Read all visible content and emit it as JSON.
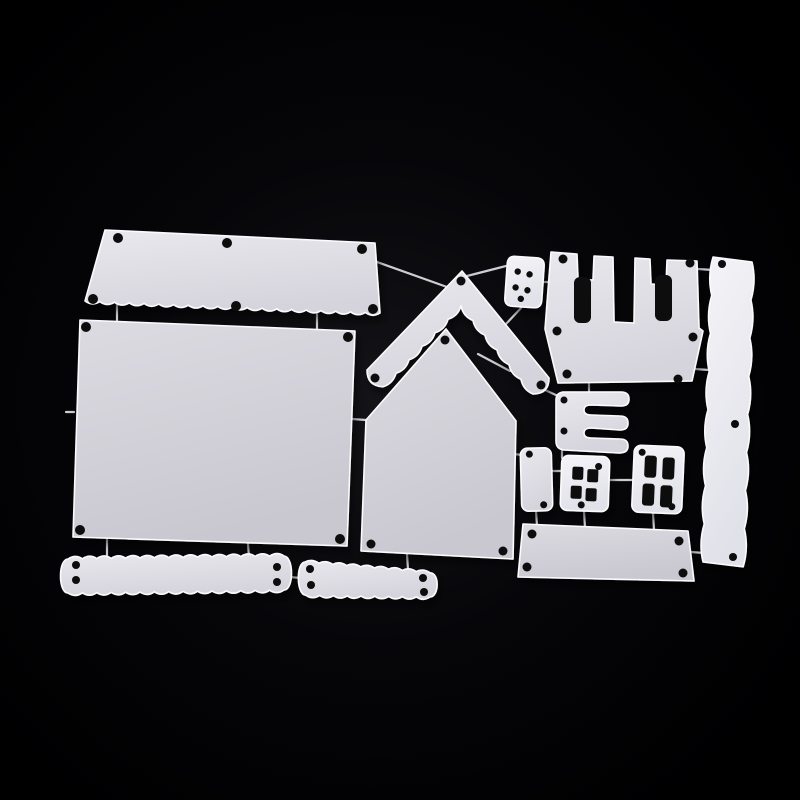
{
  "scene": {
    "description": "Product photo: silver metal cutting-die set for a 3D house (wall panels, chevron roof, scalloped eave and fence strips, castle battlement piece, window and door dies) linked by thin metal tabs on a black background",
    "background_gradient": [
      "#141418",
      "#060609",
      "#000001"
    ],
    "metal_tones": {
      "a": [
        "#dcdbe2",
        "#c9c8d0"
      ],
      "b": [
        "#e9e8ee",
        "#d5d4dc"
      ],
      "c": [
        "#f4f4f8",
        "#e1e1e9"
      ]
    },
    "edge_highlight": "#fbfbfd",
    "hole_color": "#0b0b0f",
    "connector_color": "#d8d8de",
    "shadow": {
      "dx": 3,
      "dy": 6,
      "blur": 4,
      "opacity": 0.5
    }
  },
  "pieces": [
    {
      "name": "scalloped-eave-panel",
      "tone": "b",
      "hole_r": 5,
      "path": "M 105,230 L 375,243 L 380,313 q -7.4,4.8 -14.75,-0.6 q -7.4,4.8 -14.75,-0.6 q -7.4,4.8 -14.75,-0.6 q -7.4,4.8 -14.75,-0.6 q -7.4,4.8 -14.75,-0.6 q -7.4,4.8 -14.75,-0.6 q -7.4,4.8 -14.75,-0.6 q -7.4,4.8 -14.75,-0.6 q -7.4,4.8 -14.75,-0.6 q -7.4,4.8 -14.75,-0.6 q -7.4,4.8 -14.75,-0.6 q -7.4,4.8 -14.75,-0.6 q -7.4,4.8 -14.75,-0.6 q -7.4,4.8 -14.75,-0.6 q -7.4,4.8 -14.75,-0.6 q -7.4,4.8 -14.75,-0.6 q -7.4,4.8 -14.75,-0.6 q -7.4,4.8 -14.75,-0.6 q -7.4,4.8 -14.75,-0.6 q -7.4,4.8 -14.75,-0.6 Z",
      "holes": [
        [
          118,
          238
        ],
        [
          227,
          243
        ],
        [
          362,
          249
        ],
        [
          93,
          299
        ],
        [
          236,
          306
        ],
        [
          373,
          309
        ]
      ]
    },
    {
      "name": "house-back-wall-panel",
      "tone": "a",
      "hole_r": 5,
      "path": "M 80,320 L 355,331 L 347,546 L 73,537 Z",
      "holes": [
        [
          86,
          327
        ],
        [
          348,
          337
        ],
        [
          80,
          530
        ],
        [
          340,
          539
        ]
      ]
    },
    {
      "name": "roof-gable-chevron",
      "tone": "b",
      "hole_r": 4.5,
      "path": "M 462,271 L 549,378 q 0,16 -16,16 q -9.9,-4.2 -12,-14.7 q -9.9,-4.2 -12,-14.7 q -9.9,-4.2 -12,-14.7 q -9.9,-4.2 -12,-14.7 q -9.9,-4.2 -12,-14.7 q -9.9,-4.2 -12,-14.7 q -2.9,10.2 -13,13.5 q -2.9,10.2 -13,13.5 q -2.9,10.2 -13,13.5 q -2.9,10.2 -13,13.5 q -2.9,10.2 -13,13.5 q -2.9,10.2 -13,13.5 q -16,-0.8 -16,-16.8 Z",
      "holes": [
        [
          461,
          281
        ],
        [
          375,
          378
        ],
        [
          541,
          385
        ]
      ]
    },
    {
      "name": "house-front-wall",
      "tone": "a",
      "hole_r": 4.5,
      "path": "M 446,329 L 516,421 L 513,559 L 361,551 L 366,420 Z",
      "holes": [
        [
          445,
          340
        ],
        [
          371,
          544
        ],
        [
          503,
          551
        ]
      ]
    },
    {
      "name": "dice-button-plate",
      "tone": "c",
      "hole_r": 3.2,
      "transform": "rotate(4 524 282)",
      "path": "M 514,257 L 535,257 Q 543,257 543,265 L 543,299 Q 543,307 535,307 L 514,307 Q 506,307 506,299 L 506,265 Q 506,257 514,257 Z",
      "holes": [
        [
          517,
          272
        ],
        [
          529,
          274
        ],
        [
          516,
          288
        ],
        [
          528,
          290
        ],
        [
          522,
          299
        ]
      ]
    },
    {
      "name": "castle-battlement-panel",
      "tone": "b",
      "hole_r": 4.5,
      "path": "M 551,252 L 577,254 L 578,279 L 593,280 L 594,256 L 613,257 L 614,322 L 634,323 L 635,258 L 650,259 L 651,284 L 666,285 L 667,260 L 697,261 L 699,328 L 703,331 L 692,381 L 558,383 L 545,329 Z",
      "cutouts": [
        [
          574,
          277,
          17,
          46,
          6
        ],
        [
          655,
          275,
          17,
          46,
          6
        ]
      ],
      "holes": [
        [
          563,
          259
        ],
        [
          690,
          263
        ],
        [
          557,
          331
        ],
        [
          693,
          337
        ],
        [
          567,
          374
        ],
        [
          678,
          379
        ]
      ]
    },
    {
      "name": "scalloped-side-strip",
      "tone": "c",
      "hole_r": 4,
      "path": "M 713,257 L 752,262 q 4.5,19 -1.1,38.1 q 4.5,19 -1.1,38.1 q 4.5,19 -1.1,38.1 q 4.5,19 -1.1,38.1 q 4.5,19 -1.1,38.1 q 4.5,19 -1.1,38.1 q 4.5,19 -1.1,38.1 q 4.5,19 -1.1,38.1 L 703,562 q -4.5,-19 1.25,-38.1 q -4.5,-19 1.25,-38.1 q -4.5,-19 1.25,-38.1 q -4.5,-19 1.25,-38.1 q -4.5,-19 1.25,-38.1 q -4.5,-19 1.25,-38.1 q -4.5,-19 1.25,-38.1 q -4.5,-19 1.25,-38.1 Z",
      "holes": [
        [
          722,
          264
        ],
        [
          735,
          424
        ],
        [
          733,
          557
        ]
      ]
    },
    {
      "name": "e-shaped-bracket",
      "tone": "b",
      "hole_r": 3.5,
      "path": "M 563,392 Q 556,393 556,400 L 556,441 Q 556,449 564,450 L 619,453 Q 628,453 628,446 Q 628,439 620,439 L 591,438 Q 584,438 584,433 Q 584,428 591,428 L 620,430 Q 628,430 628,423 Q 628,416 620,416 L 591,415 Q 584,415 584,410 Q 584,405 591,405 L 621,406 Q 629,406 629,399 Q 629,392 621,392 Z",
      "holes": [
        [
          564,
          400
        ],
        [
          564,
          431
        ]
      ]
    },
    {
      "name": "small-door-plate",
      "tone": "b",
      "hole_r": 3.5,
      "transform": "rotate(-1.5 536 479)",
      "rect": [
        521,
        448,
        31,
        63,
        7
      ],
      "holes": [
        [
          530,
          454
        ],
        [
          543,
          505
        ]
      ]
    },
    {
      "name": "four-pane-window",
      "tone": "c",
      "hole_r": 3.5,
      "transform": "rotate(2 585 483)",
      "rect": [
        561,
        456,
        48,
        55,
        7
      ],
      "cutouts": [
        [
          572,
          467,
          11,
          13,
          2
        ],
        [
          587,
          469,
          11,
          13,
          2
        ],
        [
          571,
          486,
          11,
          13,
          2
        ],
        [
          586,
          488,
          11,
          13,
          2
        ]
      ],
      "holes": [
        [
          598,
          466
        ],
        [
          582,
          505
        ]
      ]
    },
    {
      "name": "shuttered-window",
      "tone": "c",
      "hole_r": 3.5,
      "transform": "rotate(2.5 658 479)",
      "rect": [
        633,
        446,
        50,
        67,
        7
      ],
      "cutouts": [
        [
          644,
          456,
          12,
          22,
          3
        ],
        [
          662,
          457,
          12,
          22,
          3
        ],
        [
          643,
          484,
          12,
          22,
          3
        ],
        [
          661,
          485,
          12,
          22,
          3
        ]
      ],
      "holes": [
        [
          641,
          453
        ],
        [
          673,
          506
        ]
      ]
    },
    {
      "name": "base-plate",
      "tone": "a",
      "hole_r": 4.5,
      "path": "M 523,524 L 688,531 L 694,581 L 518,577 Z",
      "holes": [
        [
          532,
          534
        ],
        [
          679,
          541
        ],
        [
          527,
          567
        ],
        [
          683,
          573
        ]
      ]
    },
    {
      "name": "scalloped-fence-strip-left",
      "tone": "b",
      "hole_r": 4,
      "path": "M 68,559 q 7.2,-5.1 14.4,-0.2 q 7.2,-5.1 14.4,-0.2 q 7.2,-5.1 14.4,-0.2 q 7.2,-5.1 14.4,-0.2 q 7.2,-5.1 14.4,-0.2 q 7.2,-5.1 14.4,-0.2 q 7.2,-5.1 14.4,-0.2 q 7.2,-5.1 14.4,-0.2 q 7.2,-5.1 14.4,-0.2 q 7.2,-5.1 14.4,-0.2 q 7.2,-5.1 14.4,-0.2 q 7.2,-5.1 14.4,-0.2 q 7.2,-5.1 14.4,-0.2 q 7.2,-5.1 14.4,-0.2 q 7.2,-5.1 14.4,-0.2 C 294,556.5 294,590 284,590 q -7.2,5.1 -14.4,0.2 q -7.2,5.1 -14.4,0.2 q -7.2,5.1 -14.4,0.2 q -7.2,5.1 -14.4,0.2 q -7.2,5.1 -14.4,0.2 q -7.2,5.1 -14.4,0.2 q -7.2,5.1 -14.4,0.2 q -7.2,5.1 -14.4,0.2 q -7.2,5.1 -14.4,0.2 q -7.2,5.1 -14.4,0.2 q -7.2,5.1 -14.4,0.2 q -7.2,5.1 -14.4,0.2 q -7.2,5.1 -14.4,0.2 q -7.2,5.1 -14.4,0.2 q -7.2,5.1 -14.4,0.2 C 58,593 58,559 68,559 Z",
      "holes": [
        [
          76,
          565
        ],
        [
          76,
          580
        ],
        [
          277,
          567
        ],
        [
          277,
          582
        ]
      ]
    },
    {
      "name": "scalloped-fence-strip-right",
      "tone": "b",
      "hole_r": 4,
      "path": "M 305,562 q 6.9,-3.6 13.9,1.2 q 6.9,-3.6 13.9,1.2 q 6.9,-3.6 13.9,1.2 q 6.9,-3.6 13.9,1.2 q 6.9,-3.6 13.9,1.2 q 6.9,-3.6 13.9,1.2 q 6.9,-3.6 13.9,1.2 q 6.9,-3.6 13.9,1.2 q 6.9,-3.6 13.9,1.2 C 440,573 439,597 430,597 q -6.9,4.6 -13.8,-0.2 q -6.9,4.6 -13.8,-0.2 q -6.9,4.6 -13.8,-0.2 q -6.9,4.6 -13.8,-0.2 q -6.9,4.6 -13.8,-0.2 q -6.9,4.6 -13.8,-0.2 q -6.9,4.6 -13.8,-0.2 q -6.9,4.6 -13.8,-0.2 q -6.9,4.6 -13.8,-0.2 C 296,595 296,562 305,562 Z",
      "holes": [
        [
          310,
          569
        ],
        [
          311,
          585
        ],
        [
          423,
          578
        ],
        [
          424,
          592
        ]
      ]
    }
  ],
  "connectors": [
    [
      117,
      303,
      117,
      322
    ],
    [
      317,
      311,
      317,
      330
    ],
    [
      377,
      262,
      447,
      287
    ],
    [
      467,
      276,
      506,
      266
    ],
    [
      542,
      282,
      549,
      282
    ],
    [
      698,
      269,
      713,
      270
    ],
    [
      695,
      369,
      709,
      370
    ],
    [
      545,
      390,
      558,
      396
    ],
    [
      478,
      354,
      510,
      371
    ],
    [
      562,
      449,
      562,
      458
    ],
    [
      551,
      471,
      562,
      471
    ],
    [
      514,
      454,
      522,
      455
    ],
    [
      609,
      480,
      634,
      480
    ],
    [
      536,
      511,
      537,
      526
    ],
    [
      584,
      511,
      585,
      528
    ],
    [
      653,
      513,
      654,
      530
    ],
    [
      691,
      552,
      704,
      553
    ],
    [
      407,
      554,
      408,
      570
    ],
    [
      107,
      539,
      107,
      559
    ],
    [
      248,
      544,
      249,
      558
    ],
    [
      289,
      577,
      301,
      578
    ],
    [
      352,
      419,
      366,
      420
    ],
    [
      521,
      308,
      506,
      324
    ],
    [
      589,
      383,
      589,
      395
    ],
    [
      66,
      412,
      74,
      412
    ]
  ]
}
